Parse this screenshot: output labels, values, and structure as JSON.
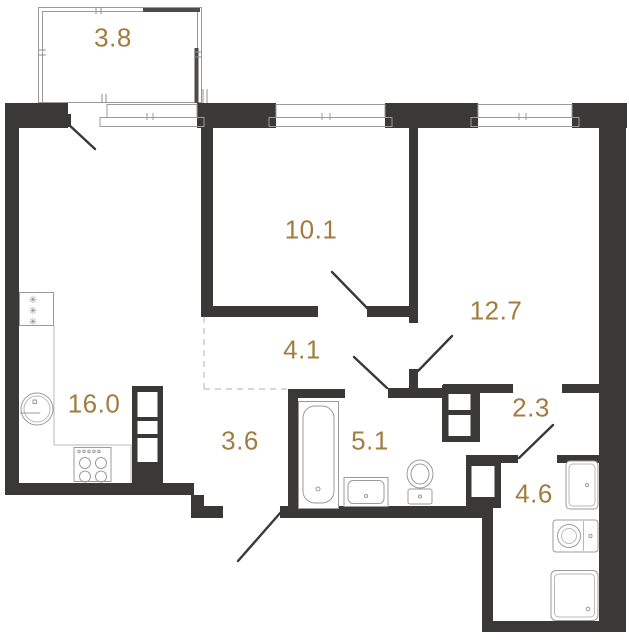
{
  "plan": {
    "type": "apartment-floor-plan",
    "background_color": "#ffffff",
    "wall_color": "#3b3937",
    "label_color": "#a27c3e",
    "fixture_line_color": "#9b9b9b",
    "rooms": [
      {
        "name": "balcony",
        "area": "3.8"
      },
      {
        "name": "bedroom-1",
        "area": "10.1"
      },
      {
        "name": "bedroom-2",
        "area": "12.7"
      },
      {
        "name": "kitchen-living",
        "area": "16.0"
      },
      {
        "name": "hallway",
        "area": "4.1"
      },
      {
        "name": "entry-hall",
        "area": "3.6"
      },
      {
        "name": "bathroom",
        "area": "5.1"
      },
      {
        "name": "inner-hall",
        "area": "2.3"
      },
      {
        "name": "shower-room",
        "area": "4.6"
      }
    ],
    "fixtures": [
      "fridge-icon",
      "kitchen-sink-icon",
      "stove-icon",
      "kitchen-counter",
      "bathtub-icon",
      "washbasin-icon",
      "toilet-icon",
      "sink-icon",
      "washing-machine-icon",
      "shower-icon",
      "ventilation-shaft",
      "window",
      "door-swing",
      "balcony-glazing"
    ]
  }
}
